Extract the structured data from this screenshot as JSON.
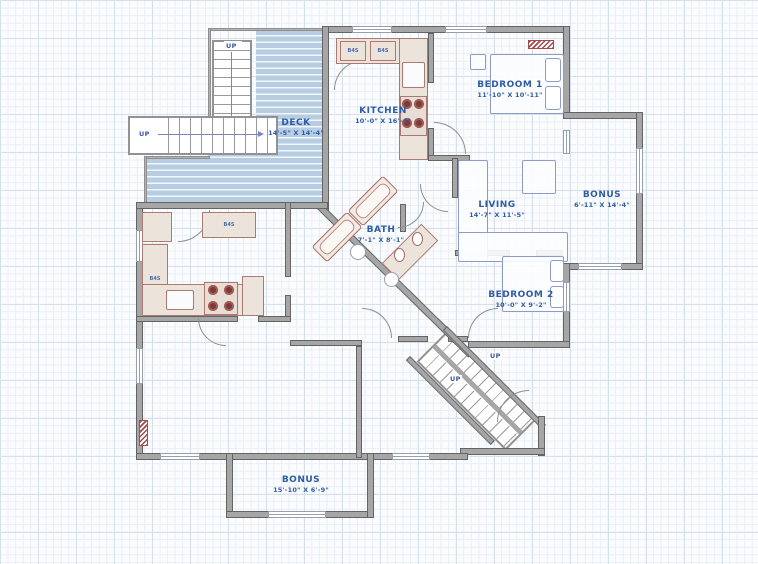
{
  "rooms": [
    {
      "name": "DECK",
      "dims": "14'-5\" X 14'-4\""
    },
    {
      "name": "KITCHEN",
      "dims": "10'-0\" X 16'-4\""
    },
    {
      "name": "BEDROOM 1",
      "dims": "11'-10\" X 10'-11\""
    },
    {
      "name": "BONUS",
      "dims": "6'-11\" X 14'-4\""
    },
    {
      "name": "LIVING",
      "dims": "14'-7\" X 11'-5\""
    },
    {
      "name": "BATH",
      "dims": "7'-1\" X 8'-1\""
    },
    {
      "name": "BEDROOM 2",
      "dims": "10'-0\" X 9'-2\""
    },
    {
      "name": "BONUS",
      "dims": "15'-10\" X 6'-9\""
    }
  ],
  "stairs": {
    "up": "UP"
  },
  "fixtures": {
    "cabinet_code": "B4S"
  },
  "colors": {
    "label_text": "#2e5ca6",
    "wall": "#a6a6a6",
    "deck_plank": "#b7cde2",
    "counter_fill": "#ece4db",
    "counter_outline": "#ab7a72",
    "burner": "#7c3a3a",
    "furniture_outline": "#8d9bc7",
    "heater": "#a64a4a",
    "grid_minor": "#e9eff6",
    "grid_major": "#d6e0ec"
  }
}
